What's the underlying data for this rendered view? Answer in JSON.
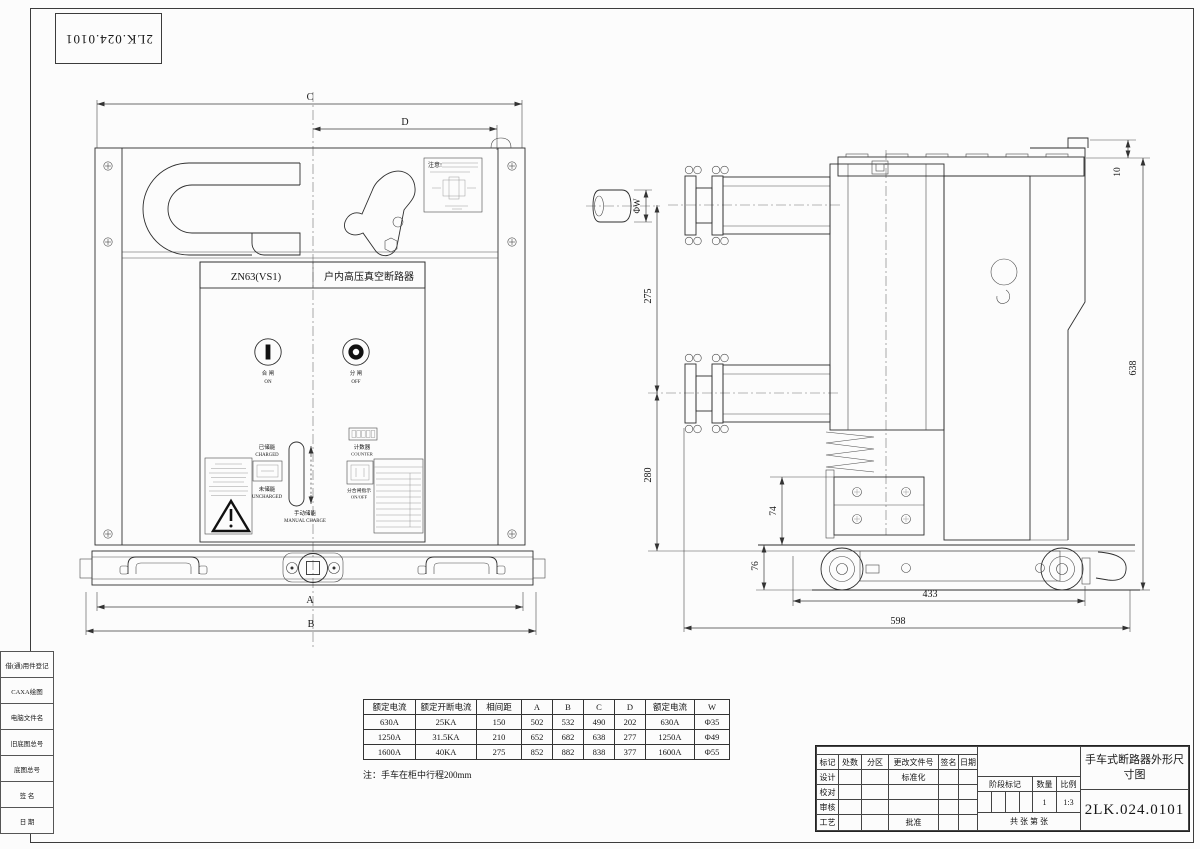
{
  "sheet": {
    "drawing_number": "2LK.024.0101",
    "title": "手车式断路器外形尺寸图"
  },
  "left_panel": {
    "rows": [
      "借(通)用件登记",
      "CAXA绘图",
      "电脑文件名",
      "旧底图总号",
      "底图总号",
      "签  名",
      "日  期"
    ]
  },
  "front": {
    "model": "ZN63(VS1)",
    "product_name": "户内高压真空断路器",
    "close_cn": "合 闸",
    "close_en": "ON",
    "open_cn": "分 闸",
    "open_en": "OFF",
    "charged_cn": "已储能",
    "charged_en": "CHARGED",
    "uncharged_cn": "未储能",
    "uncharged_en": "UNCHARGED",
    "manual_cn": "手动储能",
    "manual_en": "MANUAL CHARGE",
    "counter_cn": "计数器",
    "counter_en": "COUNTER",
    "indicator_cn": "分合闸指示",
    "indicator_en": "ON/OFF",
    "notice": "注意!",
    "dim_a": "A",
    "dim_b": "B",
    "dim_c": "C",
    "dim_d": "D"
  },
  "side": {
    "dim_phi_w": "ΦW",
    "dim_275": "275",
    "dim_280": "280",
    "dim_74": "74",
    "dim_76": "76",
    "dim_433": "433",
    "dim_598": "598",
    "dim_638": "638",
    "dim_10": "10"
  },
  "table_main": {
    "headers": [
      "额定电流",
      "额定开断电流",
      "相间距",
      "A",
      "B",
      "C",
      "D"
    ],
    "rows": [
      [
        "630A",
        "25KA",
        "150",
        "502",
        "532",
        "490",
        "202"
      ],
      [
        "1250A",
        "31.5KA",
        "210",
        "652",
        "682",
        "638",
        "277"
      ],
      [
        "1600A",
        "40KA",
        "275",
        "852",
        "882",
        "838",
        "377"
      ]
    ]
  },
  "table_w": {
    "headers": [
      "额定电流",
      "W"
    ],
    "rows": [
      [
        "630A",
        "Φ35"
      ],
      [
        "1250A",
        "Φ49"
      ],
      [
        "1600A",
        "Φ55"
      ]
    ]
  },
  "note": "注：手车在柜中行程200mm",
  "title_block": {
    "cols": [
      "标记",
      "处数",
      "分区",
      "更改文件号",
      "签名",
      "日期"
    ],
    "design": "设计",
    "standardization": "标准化",
    "check": "校对",
    "review": "审核",
    "process": "工艺",
    "approve": "批准",
    "stage_mark": "阶段标记",
    "qty_label": "数量",
    "scale_label": "比例",
    "qty": "1",
    "scale": "1:3",
    "sheets": "共  张  第  张",
    "title": "手车式断路器外形尺寸图",
    "number": "2LK.024.0101"
  }
}
